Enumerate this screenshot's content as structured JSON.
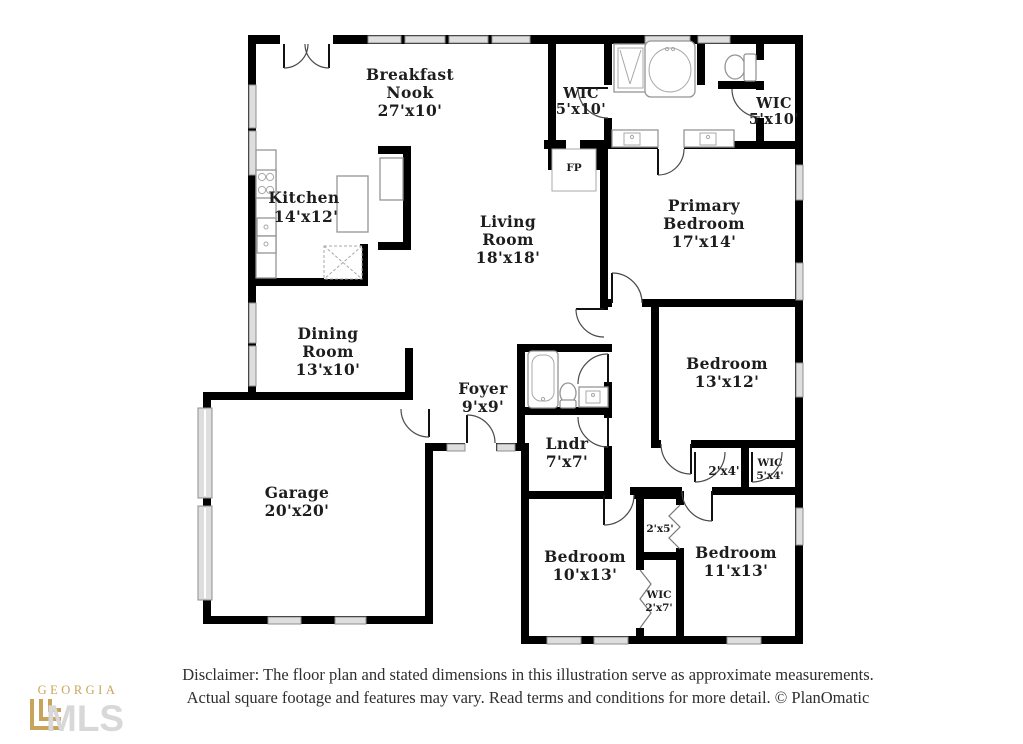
{
  "colors": {
    "background": "#ffffff",
    "wall": "#000000",
    "window_fill": "#dedede",
    "window_stroke": "#8f8f8f",
    "fixture_stroke": "#949494",
    "door_arc": "#4a4a4a",
    "label": "#1d1d1d",
    "logo_gold": "#c9a45c",
    "logo_gray": "#d8d8d8",
    "disclaimer_text": "#2e2e2e"
  },
  "rooms": {
    "breakfast_nook": {
      "lines": [
        "Breakfast",
        "Nook",
        "27'x10'"
      ]
    },
    "kitchen": {
      "lines": [
        "Kitchen",
        "14'x12'"
      ]
    },
    "living_room": {
      "lines": [
        "Living",
        "Room",
        "18'x18'"
      ]
    },
    "dining_room": {
      "lines": [
        "Dining",
        "Room",
        "13'x10'"
      ]
    },
    "foyer": {
      "lines": [
        "Foyer",
        "9'x9'"
      ]
    },
    "garage": {
      "lines": [
        "Garage",
        "20'x20'"
      ]
    },
    "laundry": {
      "lines": [
        "Lndr",
        "7'x7'"
      ]
    },
    "primary_bedroom": {
      "lines": [
        "Primary",
        "Bedroom",
        "17'x14'"
      ]
    },
    "bedroom_13x12": {
      "lines": [
        "Bedroom",
        "13'x12'"
      ]
    },
    "bedroom_10x13": {
      "lines": [
        "Bedroom",
        "10'x13'"
      ]
    },
    "bedroom_11x13": {
      "lines": [
        "Bedroom",
        "11'x13'"
      ]
    },
    "wic_left": {
      "lines": [
        "WIC",
        "5'x10'"
      ]
    },
    "wic_right": {
      "lines": [
        "WIC",
        "5'x10'"
      ]
    },
    "closet_2x4": {
      "lines": [
        "2'x4'"
      ]
    },
    "wic_5x4": {
      "lines": [
        "WIC",
        "5'x4'"
      ]
    },
    "closet_2x5": {
      "lines": [
        "2'x5'"
      ]
    },
    "wic_2x7": {
      "lines": [
        "WIC",
        "2'x7'"
      ]
    },
    "fireplace": {
      "lines": [
        "FP"
      ]
    }
  },
  "footer": {
    "disclaimer_line1": "Disclaimer: The floor plan and stated dimensions in this illustration serve as approximate measurements.",
    "disclaimer_line2": "Actual square footage and features may vary. Read terms and conditions for more detail. © PlanOmatic"
  },
  "logo": {
    "top": "GEORGIA",
    "bottom": "MLS"
  }
}
